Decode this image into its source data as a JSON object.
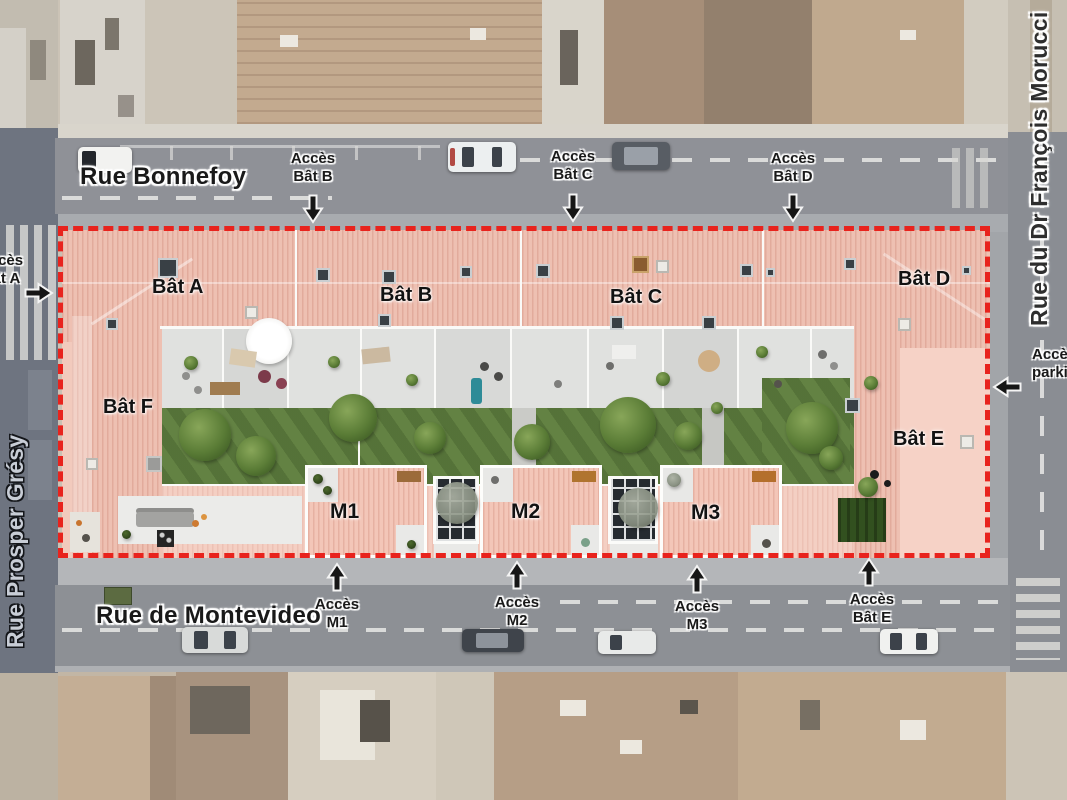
{
  "streets": {
    "bonnefoy": "Rue Bonnefoy",
    "montevideo": "Rue de Montevideo",
    "prosper_gresy": "Rue Prosper Grésy",
    "morucci": "Rue du Dr François Morucci"
  },
  "buildings": [
    {
      "id": "bat-a",
      "label": "Bât A"
    },
    {
      "id": "bat-b",
      "label": "Bât B"
    },
    {
      "id": "bat-c",
      "label": "Bât C"
    },
    {
      "id": "bat-d",
      "label": "Bât D"
    },
    {
      "id": "bat-e",
      "label": "Bât E"
    },
    {
      "id": "bat-f",
      "label": "Bât F"
    },
    {
      "id": "m1",
      "label": "M1"
    },
    {
      "id": "m2",
      "label": "M2"
    },
    {
      "id": "m3",
      "label": "M3"
    }
  ],
  "access_points": [
    {
      "id": "acces-bat-a",
      "line1": "Accès",
      "line2": "Bât A",
      "arrow": "right"
    },
    {
      "id": "acces-bat-b",
      "line1": "Accès",
      "line2": "Bât B",
      "arrow": "down"
    },
    {
      "id": "acces-bat-c",
      "line1": "Accès",
      "line2": "Bât C",
      "arrow": "down"
    },
    {
      "id": "acces-bat-d",
      "line1": "Accès",
      "line2": "Bât D",
      "arrow": "down"
    },
    {
      "id": "acces-m1",
      "line1": "Accès",
      "line2": "M1",
      "arrow": "up"
    },
    {
      "id": "acces-m2",
      "line1": "Accès",
      "line2": "M2",
      "arrow": "up"
    },
    {
      "id": "acces-m3",
      "line1": "Accès",
      "line2": "M3",
      "arrow": "up"
    },
    {
      "id": "acces-bat-e",
      "line1": "Accès",
      "line2": "Bât E",
      "arrow": "up"
    },
    {
      "id": "acces-parking",
      "line1": "Accès",
      "line2": "parking",
      "arrow": "left"
    }
  ],
  "colors": {
    "site_boundary": "#e8231d",
    "roof_pink": "#eec0b2",
    "road_gray": "#8f9197",
    "garden_green": "#5f7e40",
    "glass_roof": "#262b30"
  }
}
